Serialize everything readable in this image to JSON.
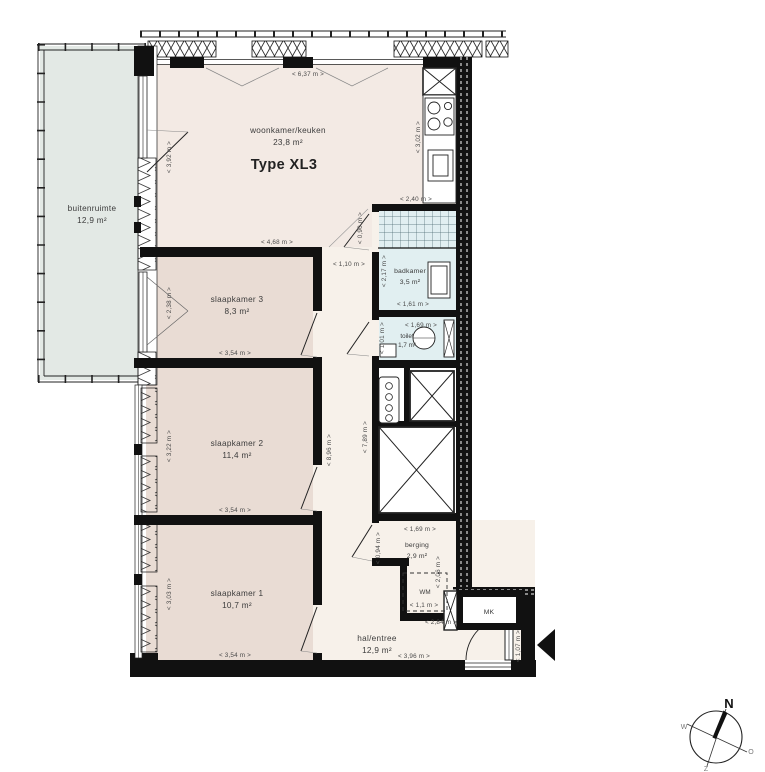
{
  "plan": {
    "type_label": "Type XL3",
    "rooms": {
      "buitenruimte": {
        "name": "buitenruimte",
        "area": "12,9 m²"
      },
      "woonkamer": {
        "name": "woonkamer/keuken",
        "area": "23,8 m²"
      },
      "slaapkamer3": {
        "name": "slaapkamer 3",
        "area": "8,3 m²"
      },
      "slaapkamer2": {
        "name": "slaapkamer 2",
        "area": "11,4 m²"
      },
      "slaapkamer1": {
        "name": "slaapkamer 1",
        "area": "10,7 m²"
      },
      "badkamer": {
        "name": "badkamer",
        "area": "3,5 m²"
      },
      "toilet": {
        "name": "toilet",
        "area": "1,7 m²"
      },
      "berging": {
        "name": "berging",
        "area": "2,9 m²"
      },
      "hal": {
        "name": "hal/entree",
        "area": "12,9 m²"
      }
    },
    "labels": {
      "wm": "WM",
      "mk": "MK"
    },
    "dims": {
      "d637": "<  6,37 m  >",
      "d392": "<  3,92 m  >",
      "d302": "<  3,02 m  >",
      "d240": "<  2,40 m  >",
      "d468": "<  4,68 m  >",
      "d090": "<  0,90 m  >",
      "d110": "<  1,10 m  >",
      "d217": "<  2,17 m  >",
      "d161": "<  1,61 m  >",
      "d169_toilet": "<  1,69 m  >",
      "d101": "<  1,01 m  >",
      "d238": "<  2,38 m  >",
      "d354_s3": "<  3,54 m  >",
      "d322": "<  3,22 m  >",
      "d354_s2": "<  3,54 m  >",
      "d896": "<  8,96 m  >",
      "d789": "<  7,89 m  >",
      "d303": "<  3,03 m  >",
      "d354_s1": "<  3,54 m  >",
      "d169_berging": "<  1,69 m  >",
      "d094": "<  0,94 m  >",
      "d206": "<  2,06 m  >",
      "d11": "<  1,1 m  >",
      "d284": "<  2,84 m  >",
      "d396": "<  3,96 m  >",
      "d107": "<  1,07 m  >"
    },
    "compass": {
      "n": "N",
      "o": "O",
      "z": "Z",
      "w": "W"
    },
    "colors": {
      "wall": "#111111",
      "living": "#f3eae4",
      "bedroom": "#e9dcd4",
      "hall": "#f7f1ea",
      "balcony": "#e3e9e5",
      "bath": "#e1eff1"
    }
  }
}
